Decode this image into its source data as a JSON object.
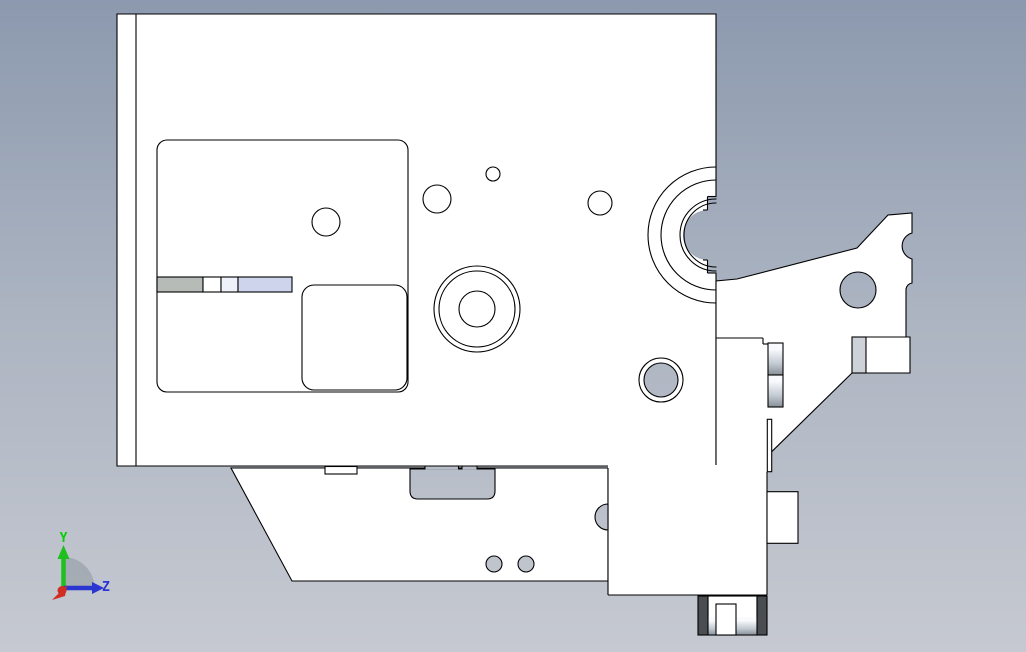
{
  "viewport": {
    "width": 1026,
    "height": 652,
    "colors": {
      "line": "#000000",
      "part_fill": "#ffffff",
      "dark_pad": "#4a4d51",
      "bg_top": "#8c99ae",
      "bg_mid": "#adb5c2",
      "bg_bottom": "#c6c9d1",
      "metal_hi": "#f8fafc",
      "metal_mid": "#c2c9d1",
      "metal_lo": "#878f98",
      "bar_gray": "#b6bbb8",
      "bar_lavender": "#cdd4eb",
      "band_gray": "#cdd2d9"
    }
  },
  "triad": {
    "labels": {
      "y": "Y",
      "z": "Z"
    },
    "colors": {
      "y_axis": "#1fbf1f",
      "z_axis": "#2b35cf",
      "x_axis": "#d22d22",
      "y_label": "#07cf07",
      "z_label": "#2b35d4",
      "fan": "#9ea5ae"
    }
  },
  "shapes": [
    {
      "name": "background",
      "type": "rect",
      "x": 0,
      "y": 0,
      "w": 1026,
      "h": 652,
      "fill": "bg"
    },
    {
      "name": "main-body",
      "type": "polygon",
      "points": "117,14 716,14 716,466 117,466",
      "fill": "white",
      "stroke": "k"
    },
    {
      "name": "left-flange-line",
      "type": "line",
      "x1": 136,
      "y1": 14,
      "x2": 136,
      "y2": 466,
      "stroke": "k"
    },
    {
      "name": "pocket-rounded-rect",
      "type": "rect",
      "x": 157,
      "y": 140,
      "w": 251,
      "h": 252,
      "rx": 10,
      "fill": "none",
      "stroke": "k"
    },
    {
      "name": "pocket-circle",
      "type": "circle",
      "cx": 326,
      "cy": 222,
      "r": 14,
      "fill": "none",
      "stroke": "k"
    },
    {
      "name": "slide-bar-gray",
      "type": "rect",
      "x": 157,
      "y": 277,
      "w": 46,
      "h": 15,
      "fill": "#b6bbb8",
      "stroke": "k"
    },
    {
      "name": "slide-bar-cell-1",
      "type": "rect",
      "x": 203,
      "y": 277,
      "w": 18,
      "h": 15,
      "fill": "white",
      "stroke": "k"
    },
    {
      "name": "slide-bar-cell-2",
      "type": "rect",
      "x": 221,
      "y": 277,
      "w": 17,
      "h": 15,
      "fill": "#eef1fa",
      "stroke": "k"
    },
    {
      "name": "slide-bar-lavender",
      "type": "rect",
      "x": 238,
      "y": 277,
      "w": 54,
      "h": 15,
      "fill": "#cdd4eb",
      "stroke": "k"
    },
    {
      "name": "pocket-rounded-rect-small",
      "type": "rect",
      "x": 302,
      "y": 285,
      "w": 105,
      "h": 105,
      "rx": 12,
      "fill": "white",
      "stroke": "k"
    },
    {
      "name": "hole-small-a",
      "type": "circle",
      "cx": 437,
      "cy": 199,
      "r": 14,
      "fill": "none",
      "stroke": "k"
    },
    {
      "name": "hole-small-b",
      "type": "circle",
      "cx": 493,
      "cy": 174,
      "r": 7,
      "fill": "none",
      "stroke": "k"
    },
    {
      "name": "hole-small-c",
      "type": "circle",
      "cx": 600,
      "cy": 203,
      "r": 12,
      "fill": "none",
      "stroke": "k"
    },
    {
      "name": "boss-circle-outer",
      "type": "circle",
      "cx": 477,
      "cy": 309,
      "r": 43,
      "fill": "none",
      "stroke": "k"
    },
    {
      "name": "boss-circle-mid",
      "type": "circle",
      "cx": 477,
      "cy": 309,
      "r": 38,
      "fill": "none",
      "stroke": "k"
    },
    {
      "name": "boss-circle-bore",
      "type": "circle",
      "cx": 477,
      "cy": 309,
      "r": 18,
      "fill": "none",
      "stroke": "k"
    },
    {
      "name": "bearing-bore-fill",
      "type": "path",
      "d": "M 717,196 L 708,196 L 708,210 A 25,25 0 0 0 708,260 L 708,273 L 717,273 Z",
      "fill": "bg"
    },
    {
      "name": "bearing-arc-outer",
      "type": "circle",
      "cx": 716,
      "cy": 235,
      "r": 68,
      "fill": "none",
      "stroke": "k",
      "clip": true
    },
    {
      "name": "bearing-arc-second",
      "type": "circle",
      "cx": 716,
      "cy": 235,
      "r": 55,
      "fill": "none",
      "stroke": "k",
      "clip": true
    },
    {
      "name": "bearing-ring-outer",
      "type": "circle",
      "cx": 716,
      "cy": 235,
      "r": 36,
      "fill": "none",
      "stroke": "k",
      "clip": true
    },
    {
      "name": "bearing-ring-inner",
      "type": "circle",
      "cx": 716,
      "cy": 235,
      "r": 32,
      "fill": "none",
      "stroke": "k",
      "clip": true
    },
    {
      "name": "bearing-step-top-h1",
      "type": "line",
      "x1": 707.5,
      "y1": 196.5,
      "x2": 716.5,
      "y2": 196.5,
      "stroke": "k"
    },
    {
      "name": "bearing-step-top-v",
      "type": "line",
      "x1": 707.5,
      "y1": 196.5,
      "x2": 707.5,
      "y2": 210,
      "stroke": "k"
    },
    {
      "name": "bearing-step-top-h2",
      "type": "line",
      "x1": 703,
      "y1": 210,
      "x2": 707.5,
      "y2": 210,
      "stroke": "k"
    },
    {
      "name": "bearing-step-bot-h1",
      "type": "line",
      "x1": 707.5,
      "y1": 273,
      "x2": 716.5,
      "y2": 273,
      "stroke": "k"
    },
    {
      "name": "bearing-step-bot-v",
      "type": "line",
      "x1": 707.5,
      "y1": 260,
      "x2": 707.5,
      "y2": 273,
      "stroke": "k"
    },
    {
      "name": "bearing-step-bot-h2",
      "type": "line",
      "x1": 703,
      "y1": 260,
      "x2": 707.5,
      "y2": 260,
      "stroke": "k"
    },
    {
      "name": "side-hole-ring",
      "type": "circle",
      "cx": 661,
      "cy": 380,
      "r": 22,
      "fill": "white",
      "stroke": "k"
    },
    {
      "name": "side-hole",
      "type": "circle",
      "cx": 661,
      "cy": 380,
      "r": 17,
      "fill": "bg",
      "stroke": "k"
    },
    {
      "name": "bracket-arm",
      "type": "polygon",
      "points": "716,281 737,279 857,248 888,215 912,213 912,283 906,289 906,337 910,337 910,373 852,373 771.7,451.7 767,455 767,466 716,466",
      "fill": "white"
    },
    {
      "name": "arm-edge-notch",
      "type": "path",
      "d": "M 912,233 A 13.5,13.5 0 0 0 912,259 Z",
      "fill": "bg"
    },
    {
      "name": "arm-edge-step-wedge",
      "type": "path",
      "d": "M 912,283 A 7,7 0 0 0 906,289 L 912,289 Z",
      "fill": "bg"
    },
    {
      "name": "bracket-arm-outline",
      "type": "path",
      "d": "M 716,466 L 716,281 L 737,279 L 857,248 L 888,215 L 912,213 L 912,233 A 13.5,13.5 0 0 0 912,259 L 912,283 A 7,7 0 0 0 906,289 L 906,337 L 910,337 L 910,373 L 852,373 L 771.7,451.7",
      "fill": "none",
      "stroke": "k"
    },
    {
      "name": "arm-plate-band",
      "type": "rect",
      "x": 852,
      "y": 337,
      "w": 14,
      "h": 36,
      "fill": "#cdd2d9",
      "stroke": "k"
    },
    {
      "name": "arm-plate-top-line",
      "type": "line",
      "x1": 866,
      "y1": 337,
      "x2": 906,
      "y2": 337,
      "stroke": "k"
    },
    {
      "name": "arm-bottom-line",
      "type": "line",
      "x1": 716,
      "y1": 338,
      "x2": 763,
      "y2": 338,
      "stroke": "k"
    },
    {
      "name": "arm-bottom-step-v",
      "type": "line",
      "x1": 763,
      "y1": 338,
      "x2": 763,
      "y2": 344,
      "stroke": "k"
    },
    {
      "name": "arm-bottom-step-h",
      "type": "line",
      "x1": 763,
      "y1": 344,
      "x2": 768,
      "y2": 344,
      "stroke": "k"
    },
    {
      "name": "arm-hole",
      "type": "circle",
      "cx": 858,
      "cy": 290,
      "r": 18,
      "fill": "bg",
      "stroke": "k"
    },
    {
      "name": "base-pedestal",
      "type": "polygon",
      "points": "231,468 608,468 608,581 292,581",
      "fill": "white",
      "stroke": "k"
    },
    {
      "name": "pedestal-notch",
      "type": "rect",
      "x": 325,
      "y": 466.5,
      "w": 32,
      "h": 7.5,
      "fill": "white",
      "stroke": "k"
    },
    {
      "name": "pedestal-slot",
      "type": "path",
      "d": "M 410,469 L 495,469 L 495,491 Q 495,499 487,499 L 418,499 Q 410,499 410,491 Z",
      "fill": "bg",
      "stroke": "k"
    },
    {
      "name": "slot-recess-a",
      "type": "rect",
      "x": 425,
      "y": 466.8,
      "w": 33.5,
      "h": 2.6,
      "fill": "bg"
    },
    {
      "name": "slot-recess-b",
      "type": "rect",
      "x": 462,
      "y": 466.8,
      "w": 15,
      "h": 2.6,
      "fill": "bg"
    },
    {
      "name": "slot-tick-1",
      "type": "line",
      "x1": 425,
      "y1": 466.5,
      "x2": 425,
      "y2": 469.5,
      "stroke": "k"
    },
    {
      "name": "slot-tick-2",
      "type": "line",
      "x1": 458.5,
      "y1": 466.5,
      "x2": 458.5,
      "y2": 469.5,
      "stroke": "k"
    },
    {
      "name": "slot-tick-3",
      "type": "line",
      "x1": 462,
      "y1": 466.5,
      "x2": 462,
      "y2": 469.5,
      "stroke": "k"
    },
    {
      "name": "slot-tick-4",
      "type": "line",
      "x1": 477,
      "y1": 466.5,
      "x2": 477,
      "y2": 469.5,
      "stroke": "k"
    },
    {
      "name": "support-block",
      "type": "rect",
      "x": 608,
      "y": 465,
      "w": 159,
      "h": 130,
      "fill": "white"
    },
    {
      "name": "block-left-edge",
      "type": "line",
      "x1": 608,
      "y1": 468,
      "x2": 608,
      "y2": 595,
      "stroke": "k"
    },
    {
      "name": "block-bottom-edge",
      "type": "line",
      "x1": 608,
      "y1": 595,
      "x2": 767,
      "y2": 595,
      "stroke": "k"
    },
    {
      "name": "block-right-edge",
      "type": "line",
      "x1": 767,
      "y1": 472,
      "x2": 767,
      "y2": 595,
      "stroke": "k"
    },
    {
      "name": "pedestal-bulge",
      "type": "path",
      "d": "M 608,504 A 13,13 0 0 0 608,530 Z",
      "fill": "bg",
      "stroke": "k"
    },
    {
      "name": "pedestal-hole-1",
      "type": "circle",
      "cx": 494,
      "cy": 564,
      "r": 8,
      "fill": "bg",
      "stroke": "k"
    },
    {
      "name": "pedestal-hole-2",
      "type": "circle",
      "cx": 526,
      "cy": 564,
      "r": 8,
      "fill": "bg",
      "stroke": "k"
    },
    {
      "name": "side-tab",
      "type": "rect",
      "x": 767,
      "y": 491.7,
      "w": 31,
      "h": 51.6,
      "fill": "white",
      "stroke": "k"
    },
    {
      "name": "shaft-strip-upper",
      "type": "rect",
      "x": 768,
      "y": 343,
      "w": 15,
      "h": 32,
      "fill": "metal",
      "stroke": "k"
    },
    {
      "name": "shaft-strip-lower",
      "type": "rect",
      "x": 768,
      "y": 375,
      "w": 15,
      "h": 32,
      "fill": "metal",
      "stroke": "k"
    },
    {
      "name": "edge-sliver",
      "type": "rect",
      "x": 767.3,
      "y": 419.3,
      "w": 4.4,
      "h": 52.4,
      "fill": "white",
      "stroke": "k"
    },
    {
      "name": "foot-body",
      "type": "rect",
      "x": 708,
      "y": 596,
      "w": 49,
      "h": 39,
      "fill": "white",
      "stroke": "k"
    },
    {
      "name": "foot-metal-left",
      "type": "rect",
      "x": 708,
      "y": 617,
      "w": 8,
      "h": 18,
      "fill": "metal"
    },
    {
      "name": "foot-metal-right",
      "type": "rect",
      "x": 736,
      "y": 617,
      "w": 21,
      "h": 18,
      "fill": "metal"
    },
    {
      "name": "foot-pillar",
      "type": "rect",
      "x": 716,
      "y": 604,
      "w": 20,
      "h": 31,
      "fill": "white",
      "stroke": "k"
    },
    {
      "name": "foot-pad-left",
      "type": "rect",
      "x": 698,
      "y": 596,
      "w": 10,
      "h": 39,
      "fill": "dark",
      "stroke": "k"
    },
    {
      "name": "foot-pad-right",
      "type": "rect",
      "x": 757,
      "y": 596,
      "w": 10,
      "h": 39,
      "fill": "dark",
      "stroke": "k"
    },
    {
      "name": "foot-bottom-line",
      "type": "line",
      "x1": 698,
      "y1": 635,
      "x2": 767,
      "y2": 635,
      "stroke": "k"
    }
  ]
}
